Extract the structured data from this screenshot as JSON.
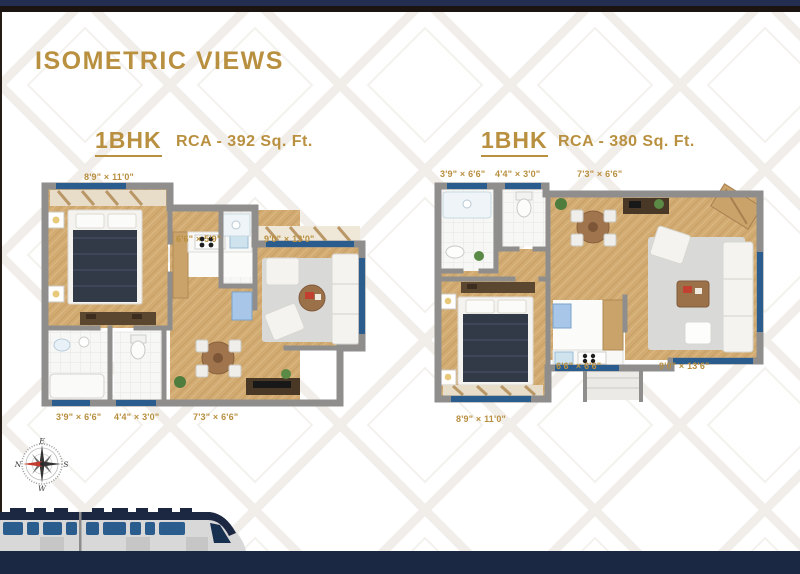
{
  "page": {
    "title": "ISOMETRIC VIEWS"
  },
  "units": [
    {
      "name": "1BHK",
      "rca": "RCA - 392 Sq. Ft.",
      "dims": {
        "bedroom": "8'9\" × 11'0\"",
        "kitchen": "6'6\" × 5'9\"",
        "living": "9'0\" × 13'0\"",
        "bath": "3'9\" × 6'6\"",
        "wc": "4'4\" × 3'0\"",
        "foyer": "7'3\" × 6'6\""
      }
    },
    {
      "name": "1BHK",
      "rca": "RCA - 380 Sq. Ft.",
      "dims": {
        "bath": "3'9\" × 6'6\"",
        "wc": "4'4\" × 3'0\"",
        "dining": "7'3\" × 6'6\"",
        "kitchen": "6'6\" × 6'6\"",
        "living": "9'0\" × 13'6\"",
        "bedroom": "8'9\" × 11'0\""
      }
    }
  ],
  "compass": {
    "north": "N",
    "east": "E",
    "south": "S",
    "west": "W"
  },
  "colors": {
    "gold": "#B9903F",
    "top_bar_navy": "#232E50",
    "bottom_bar_navy": "#1B2843",
    "window_blue": "#2B5C8E",
    "wall_gray": "#8F8E8C",
    "wood_floor": "#D2AB72",
    "rug_gray": "#D9DAD8",
    "needle_red": "#C23B2E"
  }
}
